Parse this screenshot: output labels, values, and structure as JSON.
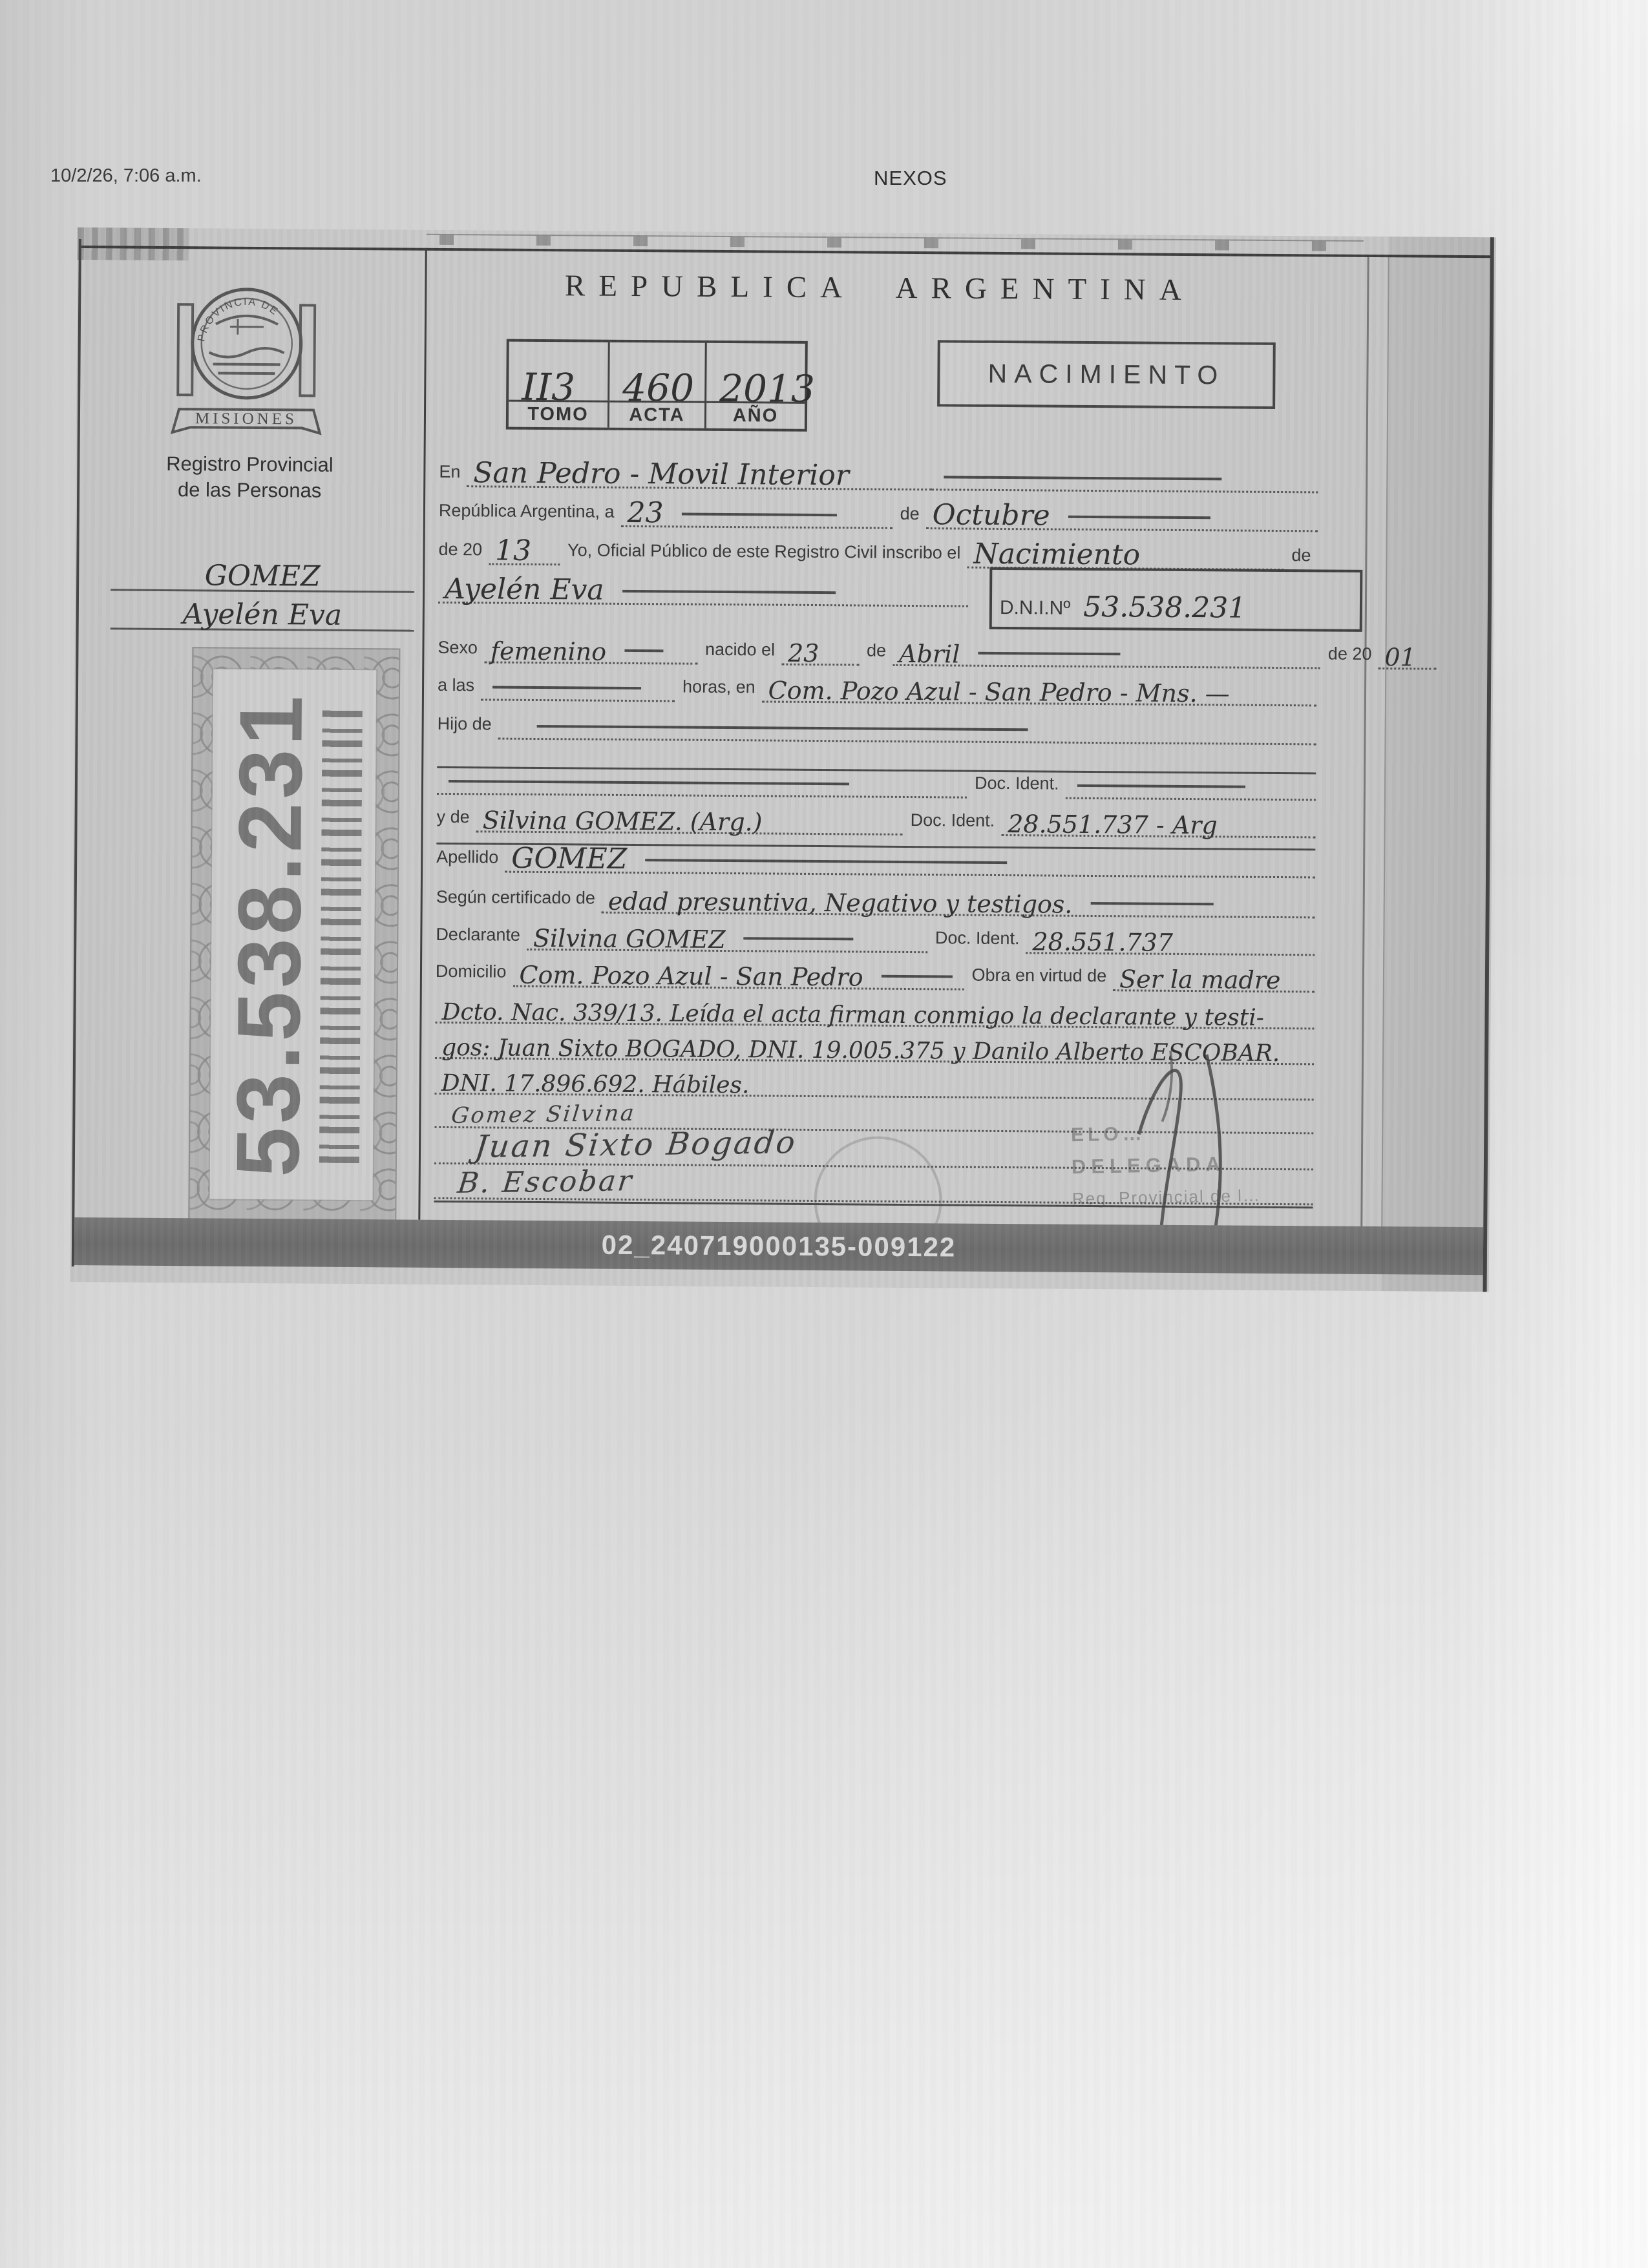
{
  "page": {
    "printed_timestamp": "10/2/26, 7:06 a.m.",
    "site_name": "NEXOS"
  },
  "cert": {
    "title": "REPUBLICA ARGENTINA",
    "event_type": "NACIMIENTO",
    "registry_office": {
      "line1": "Registro Provincial",
      "line2": "de las Personas",
      "emblem_top": "PROVINCIA DE",
      "emblem_banner": "MISIONES"
    },
    "book": {
      "headers": [
        "TOMO",
        "ACTA",
        "AÑO"
      ],
      "values": [
        "II3",
        "460",
        "2013"
      ]
    },
    "margin": {
      "surname": "GOMEZ",
      "given_names": "Ayelén Eva",
      "dni_number": "53.538.231"
    },
    "fields": {
      "en": {
        "label": "En",
        "value": "San Pedro - Movil Interior"
      },
      "fecha": {
        "label": "República Argentina, a",
        "day": "23",
        "de": "de",
        "month": "Octubre"
      },
      "inscribo": {
        "label_pre": "de 20",
        "yy": "13",
        "label_mid": "Yo, Oficial Público de este Registro Civil inscribo el",
        "value": "Nacimiento",
        "label_post": "de"
      },
      "nombre": {
        "value": "Ayelén Eva"
      },
      "dni_box": {
        "label": "D.N.I.Nº",
        "value": "53.538.231"
      },
      "sexo": {
        "label": "Sexo",
        "value": "femenino",
        "label_nacido": "nacido el",
        "day": "23",
        "de": "de",
        "month": "Abril",
        "label_anio": "de 20",
        "yy": "01"
      },
      "hora": {
        "label": "a las",
        "label2": "horas, en",
        "value": "Com. Pozo Azul - San Pedro - Mns. —"
      },
      "hijo": {
        "label": "Hijo de"
      },
      "doc_ident": {
        "label": "Doc. Ident."
      },
      "madre": {
        "label": "y de",
        "value": "Silvina GOMEZ. (Arg.)",
        "label2": "Doc. Ident.",
        "value2": "28.551.737 - Arg"
      },
      "apellido": {
        "label": "Apellido",
        "value": "GOMEZ"
      },
      "certificado": {
        "label": "Según certificado de",
        "value": "edad presuntiva, Negativo y testigos."
      },
      "declarante": {
        "label": "Declarante",
        "value": "Silvina GOMEZ",
        "label2": "Doc. Ident.",
        "value2": "28.551.737"
      },
      "domicilio": {
        "label": "Domicilio",
        "value": "Com. Pozo Azul - San Pedro",
        "label2": "Obra en virtud de",
        "value2": "Ser la madre"
      }
    },
    "body_lines": [
      "Dcto. Nac. 339/13. Leída el acta firman conmigo la declarante y testi-",
      "gos: Juan Sixto BOGADO, DNI. 19.005.375 y Danilo Alberto ESCOBAR.",
      "DNI. 17.896.692. Hábiles."
    ],
    "signatures": [
      "Gomez Silvina",
      "Juan Sixto Bogado",
      "B. Escobar"
    ],
    "stamp": {
      "line1": "ELO…",
      "line2": "DELEGADA",
      "line3": "Reg. Provincial de l…"
    },
    "footer_code": "02_240719000135-009122"
  }
}
